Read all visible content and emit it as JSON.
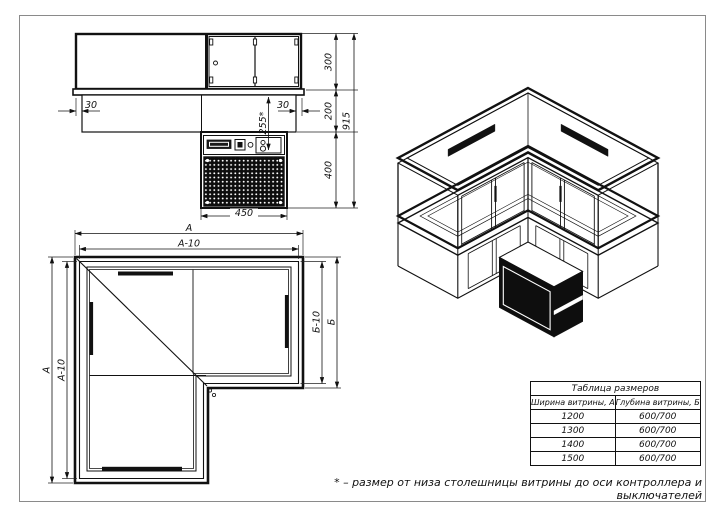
{
  "page": {
    "background": "#ffffff",
    "frame_color": "#8a8a8a",
    "line_color": "#111111",
    "fill_dark": "#0e0e0e"
  },
  "views": {
    "elevation": {
      "dims": {
        "inset_left": "30",
        "inset_right": "30",
        "controller_axis": "255*",
        "upper": "300",
        "middle": "200",
        "lower": "400",
        "total": "915",
        "condenser_width": "450"
      }
    },
    "plan": {
      "dims": {
        "width_top": "А",
        "width_top_inner": "А-10",
        "height_left": "А",
        "height_left_inner": "А-10",
        "depth_right": "Б",
        "depth_right_inner": "Б-10"
      }
    }
  },
  "size_table": {
    "title": "Таблица размеров",
    "columns": [
      "Ширина витрины, А",
      "Глубина витрины, Б"
    ],
    "rows": [
      [
        "1200",
        "600/700"
      ],
      [
        "1300",
        "600/700"
      ],
      [
        "1400",
        "600/700"
      ],
      [
        "1500",
        "600/700"
      ]
    ]
  },
  "footnote": "* – размер от низа столешницы витрины до оси контроллера и выключателей"
}
